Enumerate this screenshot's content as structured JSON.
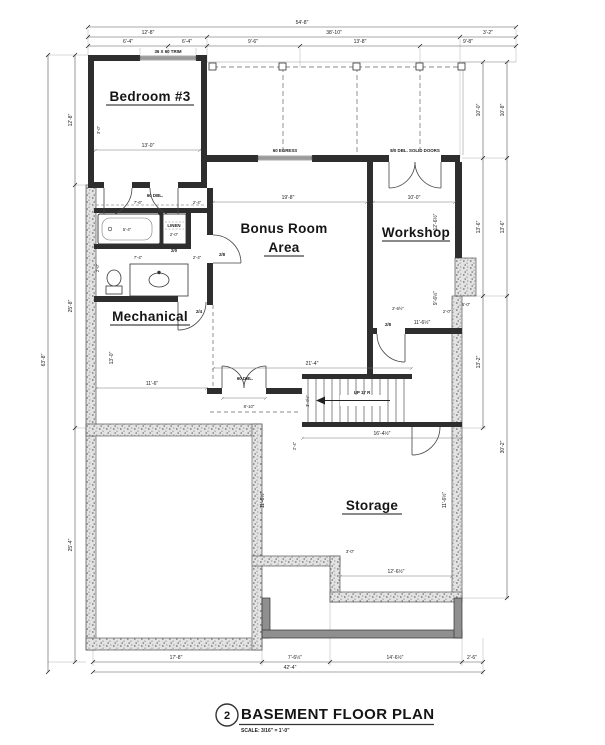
{
  "title": {
    "number": "2",
    "text": "BASEMENT FLOOR PLAN",
    "scale": "SCALE: 3/16\" = 1'-0\""
  },
  "rooms": {
    "bedroom": "Bedroom #3",
    "bonus_line1": "Bonus Room",
    "bonus_line2": "Area",
    "workshop": "Workshop",
    "mechanical": "Mechanical",
    "storage": "Storage"
  },
  "notes": {
    "window_trim": "36 X 60 TRIM",
    "egress": "60 EGRESS",
    "solid_doors": "8/0 DBL. SOLID DOORS",
    "dbl_hall": "60 DBL.",
    "dbl_bonus": "60 DBL.",
    "up": "UP 17 R",
    "linen": "LINEN",
    "d28": "2/8",
    "d20": "2/0",
    "d24": "2/4"
  },
  "dims": {
    "top": {
      "overall": "54'-8\"",
      "row2": [
        "12'-8\"",
        "38'-10\"",
        "3'-2\""
      ],
      "row3": [
        "6'-4\"",
        "6'-4\"",
        "9'-6\"",
        "13'-8\"",
        "9'-8\""
      ]
    },
    "left": {
      "overall": "63'-8\"",
      "segments": [
        "12'-8\"",
        "25'-8\"",
        "25'-4\""
      ]
    },
    "right": {
      "inner": [
        "10'-0\"",
        "13'-6\"",
        "13'-2\""
      ],
      "outer": [
        "10'-8\"",
        "13'-6\"",
        "30'-2\""
      ]
    },
    "bottom": {
      "segments": [
        "17'-8\"",
        "7'-6½\"",
        "14'-6½\"",
        "2'-6\""
      ],
      "overall": "42'-4\""
    },
    "interior": {
      "bedroom_w": "13'-0\"",
      "bedroom_h": "3'-0\"",
      "bonus_w": "19'-8\"",
      "workshop_w": "10'-0\"",
      "hall_w": "7'-6\"",
      "hall_a": "2'-4\"",
      "bath_w": "7'-4\"",
      "bath_a": "2'-4\"",
      "bath_h": "2'-0\"",
      "tub": "5'-4\"",
      "linen_w": "2'-0\"",
      "mech_w": "11'-6\"",
      "mech_h": "13'-0\"",
      "dbl_w": "8'-10\"",
      "stairs_top_w": "21'-4\"",
      "stairs_bottom_w": "16'-4½\"",
      "stairs_h": "3'-4½\"",
      "stairs_v": "2'-4\"",
      "ws_a": "12'-6½\"",
      "ws_b": "9'-6½\"",
      "ws_c": "11'-6½\"",
      "ws_d": "2'-0\"",
      "ws_e": "2'-6½\"",
      "storage_l": "11'-6½\"",
      "storage_r": "11'-6½\"",
      "storage_b": "12'-6½\"",
      "notch_a": "3'-0\"",
      "notch_b": "6'-0\""
    }
  },
  "colors": {
    "ink": "#2b2b2b",
    "concrete": "#e6e6e6",
    "patio_wall": "#8f8f8f"
  }
}
